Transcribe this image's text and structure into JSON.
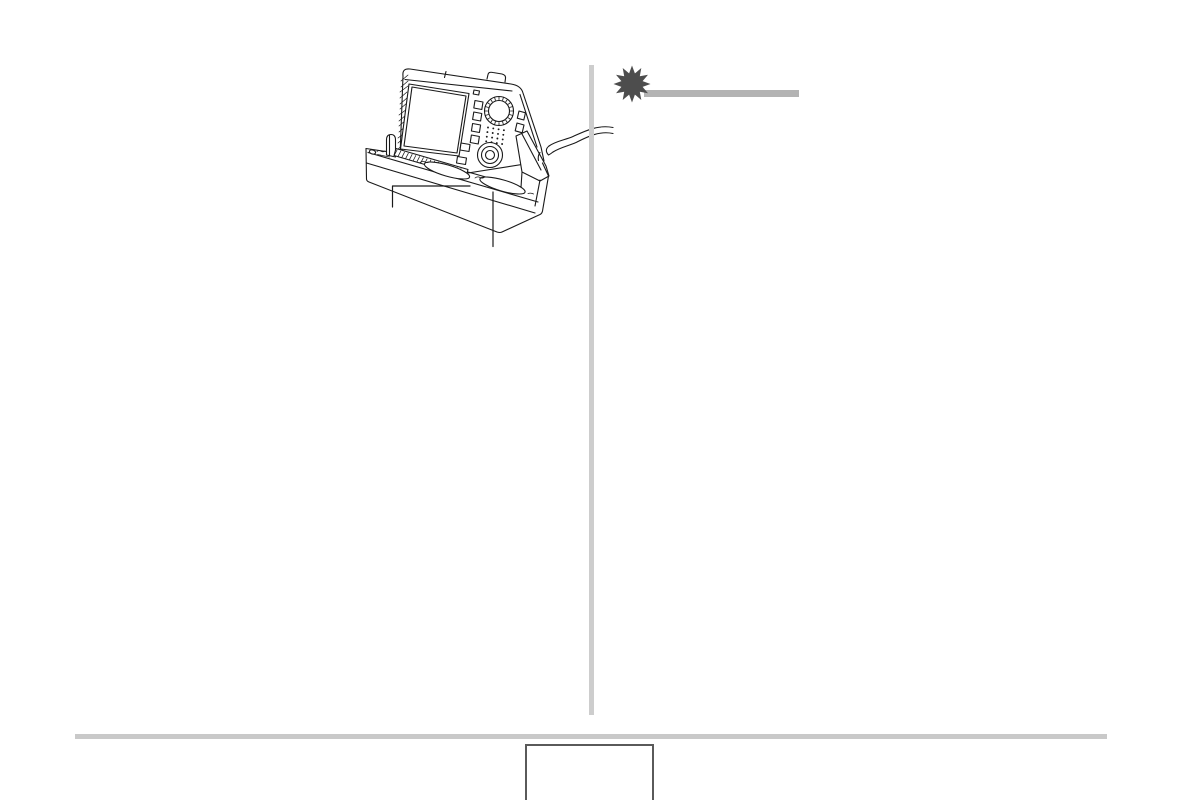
{
  "page": {
    "kind": "user manual page, two columns, no visible body text",
    "width_px": 1183,
    "height_px": 800,
    "background": "#ffffff"
  },
  "colors": {
    "line_art": "#1a1a1a",
    "starburst": "#4d4d4d",
    "header_rule": "#b3b3b3",
    "column_divider": "#cdcdcd",
    "footer_rule": "#c9c9c9",
    "page_box_border": "#5a5a5a",
    "paper": "#ffffff"
  },
  "left_column": {
    "illustration": {
      "name": "camera-docked-in-usb-cradle",
      "style": "monochrome line drawing",
      "depicts": [
        "digital camera tilted back in cradle",
        "large LCD screen with hatched left edge",
        "mode dial with knurled rim",
        "column of small buttons",
        "speaker hole grid",
        "circular 4-way controller with center button",
        "cradle base with beveled front",
        "two oval cradle buttons with tiny engraved marks",
        "small indicator lamp on cradle deck",
        "support post",
        "wavy cable squiggle at right side"
      ],
      "callout_lines": 2
    }
  },
  "right_column": {
    "section_marker": {
      "icon": "starburst-icon",
      "heading_text": ""
    }
  },
  "footer": {
    "page_number_box_text": ""
  }
}
